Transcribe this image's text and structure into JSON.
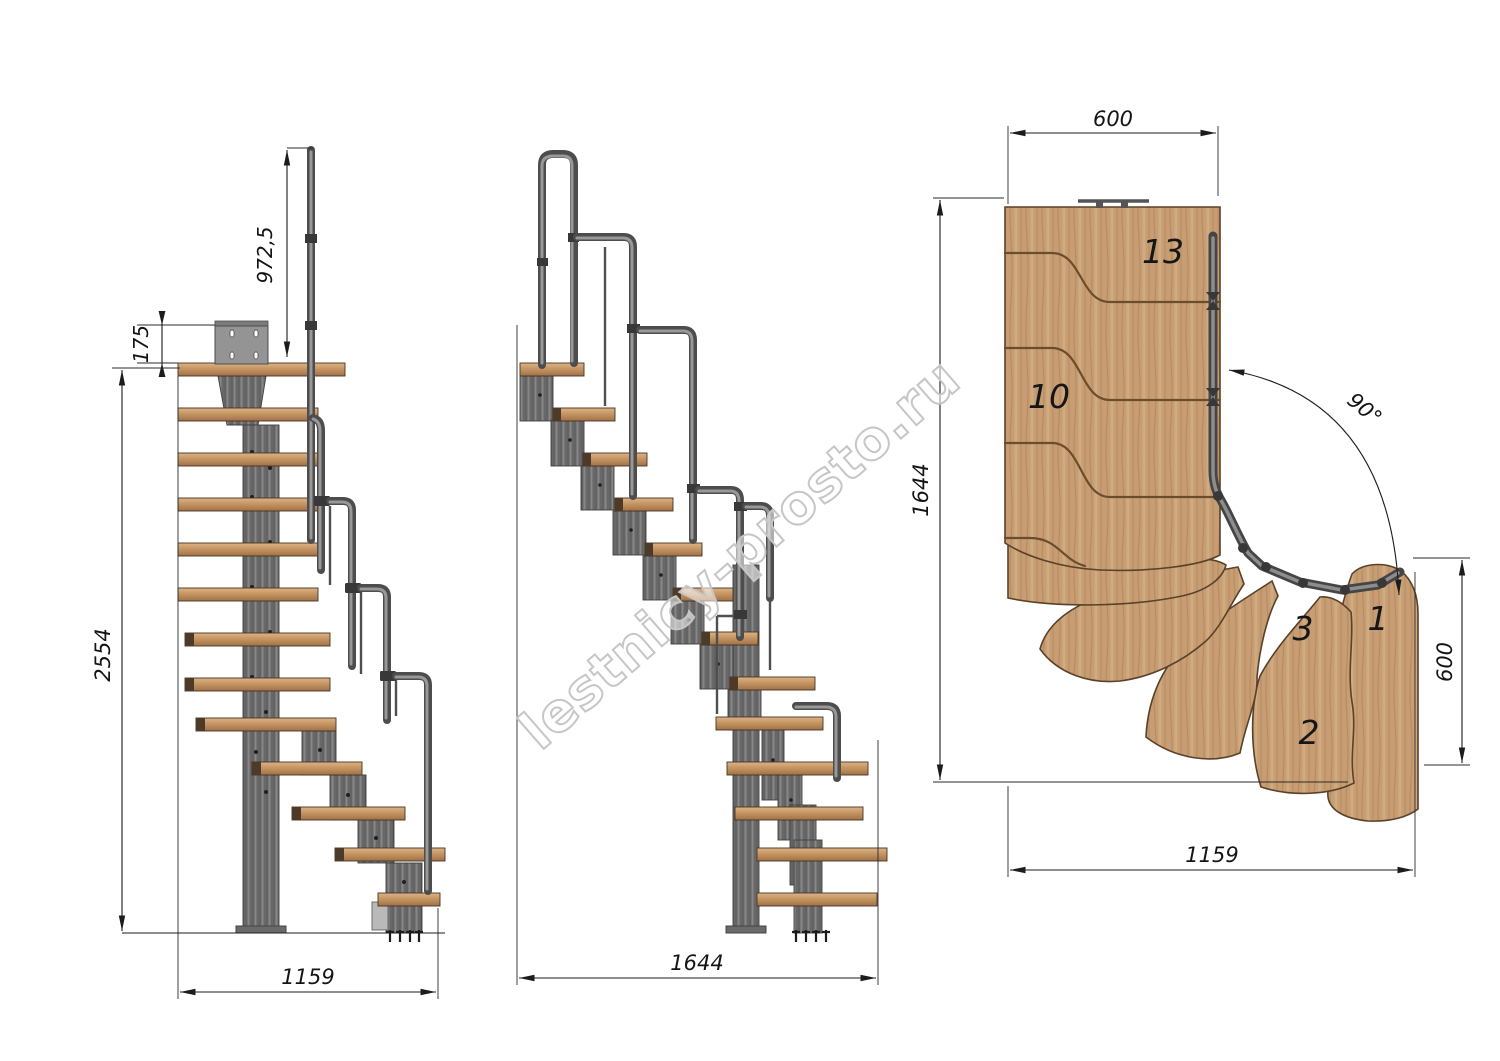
{
  "watermark": {
    "text": "lestnicy-prosto.ru"
  },
  "drawing": {
    "front_view": {
      "dim_handrail_height": "972,5",
      "dim_mount_plate": "175",
      "dim_total_height": "2554",
      "dim_footprint_width": "1159"
    },
    "side_view": {
      "dim_footprint_length": "1644"
    },
    "plan_view": {
      "dim_march_width": "600",
      "dim_flight_length": "1644",
      "dim_turn_angle": "90°",
      "dim_exit_width": "600",
      "dim_total_length": "1159",
      "steps": {
        "s13": "13",
        "s10": "10",
        "s3": "3",
        "s2": "2",
        "s1": "1"
      }
    },
    "colors": {
      "wood": "#c79d73",
      "wood_edge": "#5a4128",
      "metal": "#6e6e6e",
      "metal_dark": "#474747",
      "dimension": "#1c1c1c",
      "watermark_outline": "#c6c6c6"
    }
  }
}
